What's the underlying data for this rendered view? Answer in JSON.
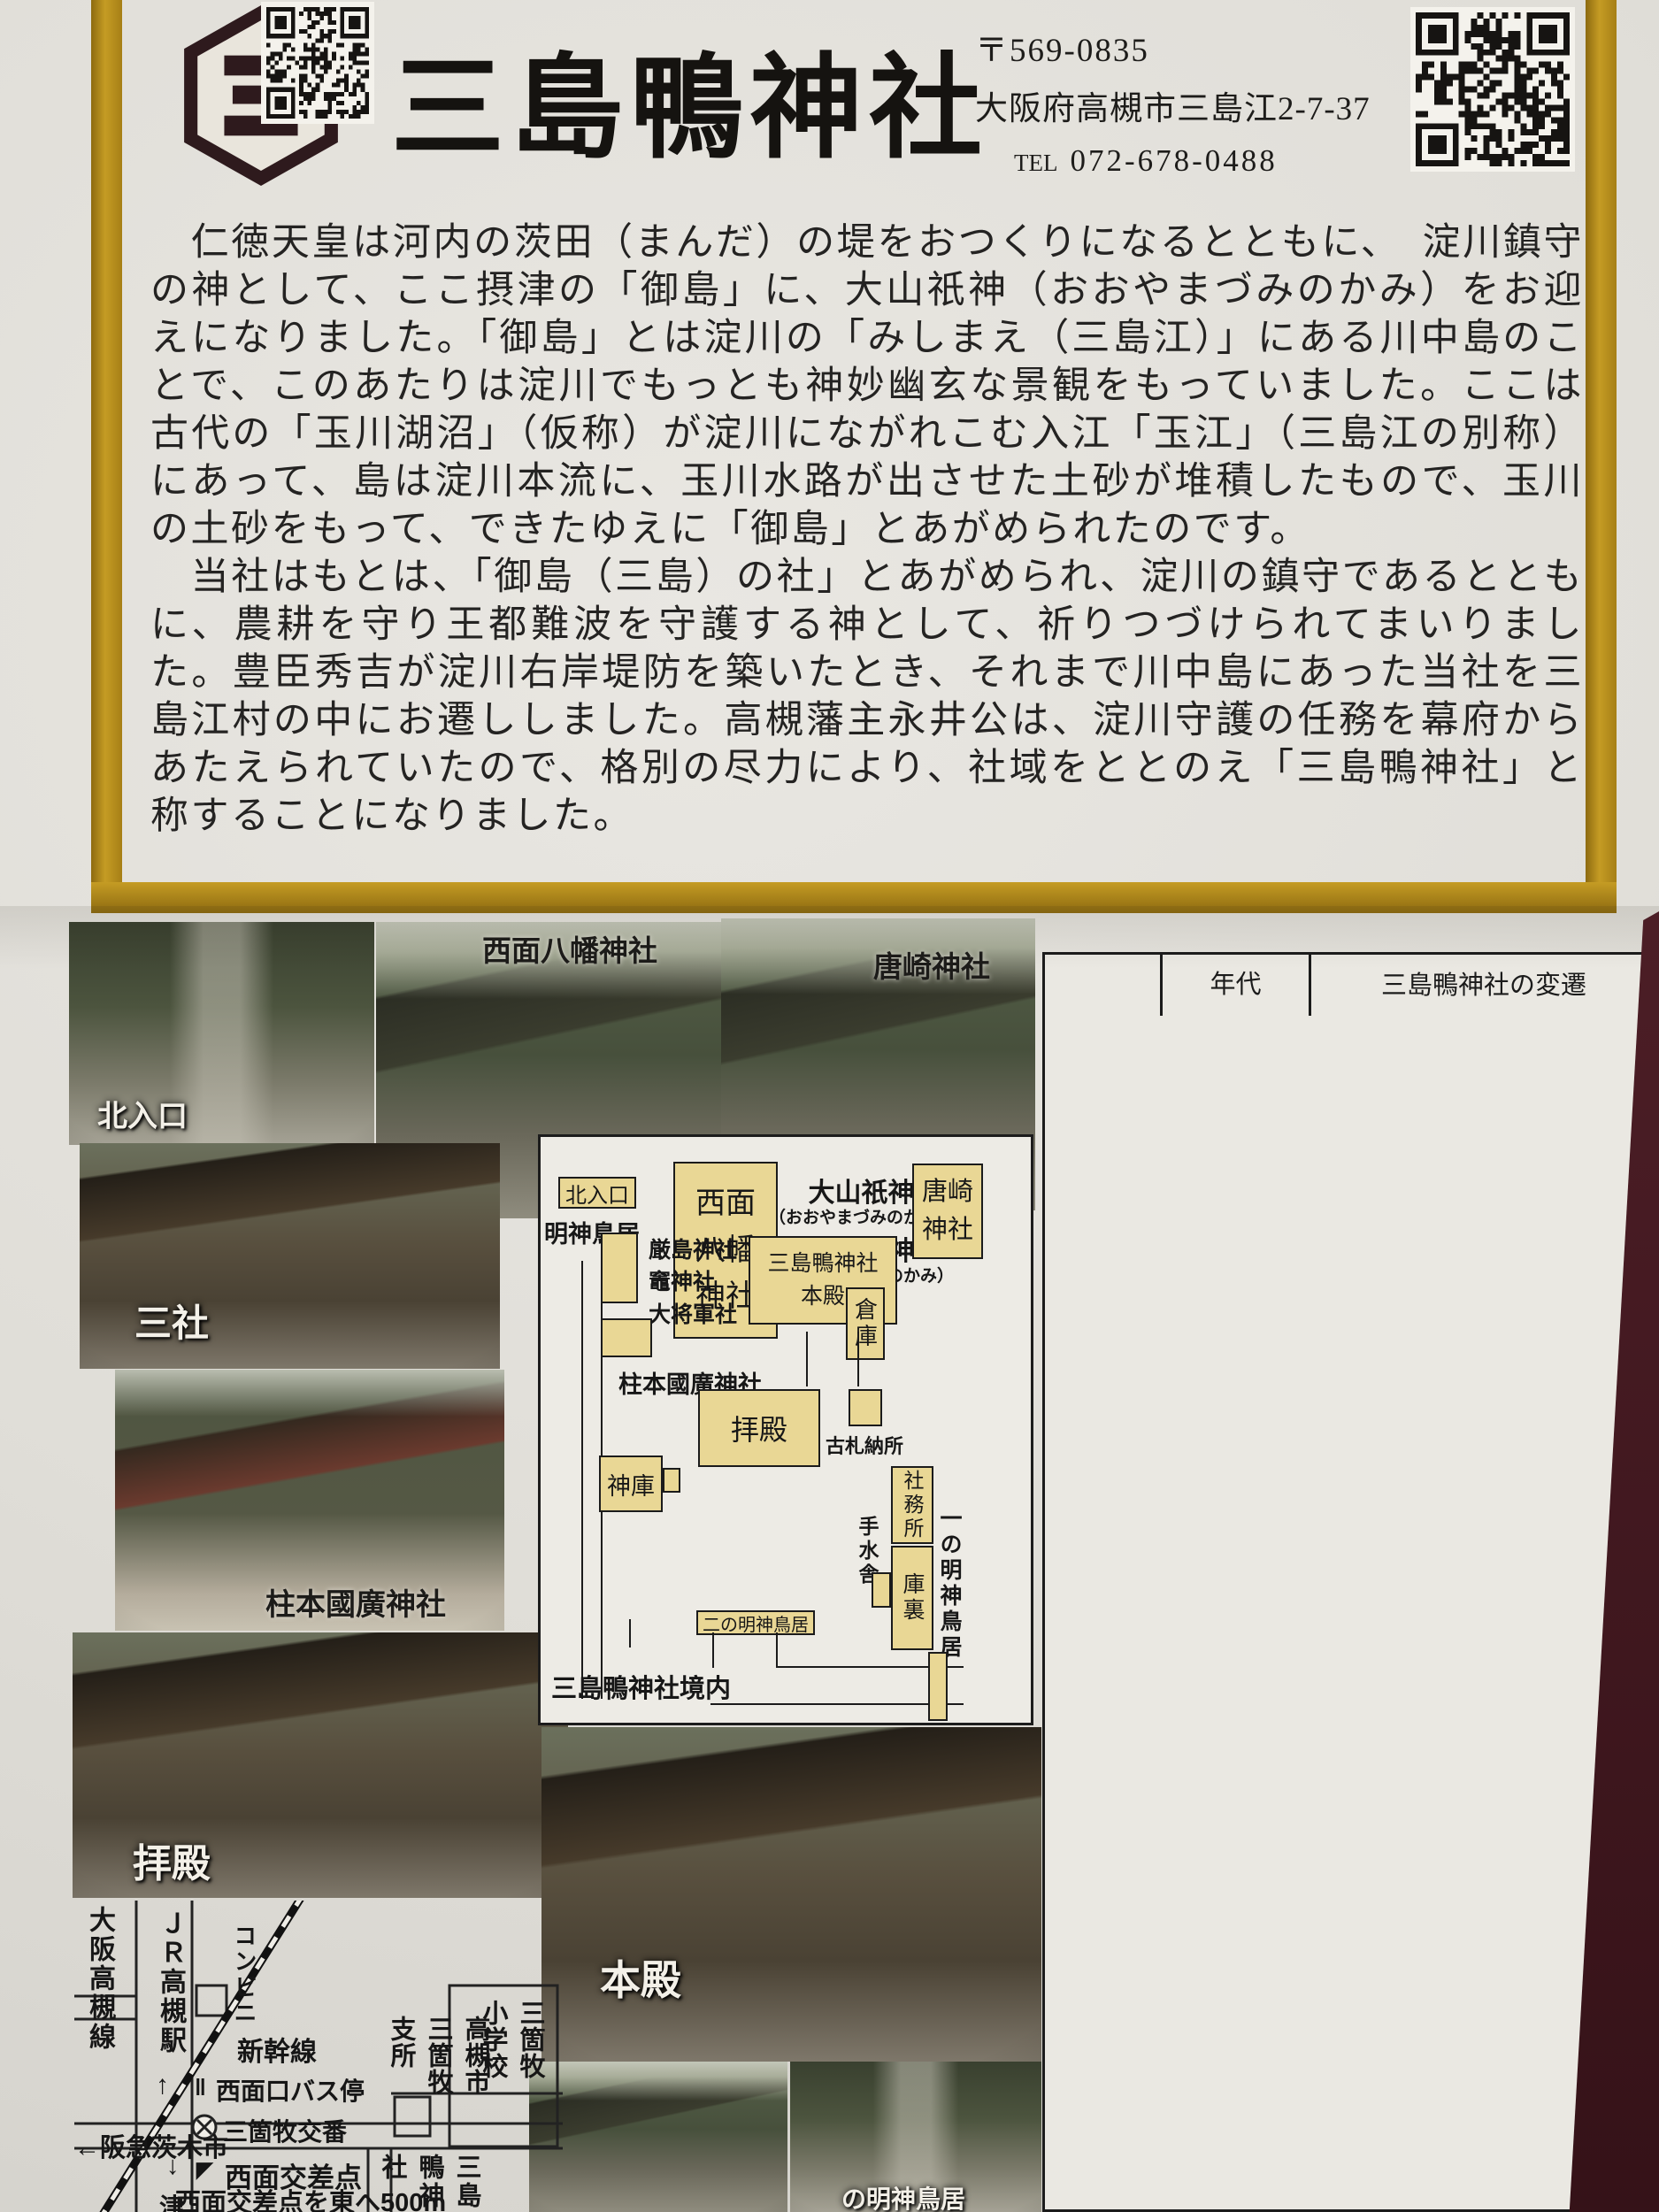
{
  "colors": {
    "gold": "#b9901f",
    "maroon": "#4a1d24",
    "box_tan": "#e9d795",
    "paper": "#e3e1db",
    "ink": "#1b1b1b"
  },
  "header": {
    "title": "三島鴨神社",
    "postal": "〒569-0835",
    "address": "大阪府高槻市三島江2-7-37",
    "tel_label": "TEL",
    "tel": "072-678-0488"
  },
  "intro": {
    "para1": "　仁徳天皇は河内の茨田（まんだ）の堤をおつくりになるとともに、　淀川鎮守の神として、ここ摂津の「御島」に、大山祇神（おおやまづみのかみ）をお迎えになりました。「御島」とは淀川の「みしまえ（三島江）」にある川中島のことで、このあたりは淀川でもっとも神妙幽玄な景観をもっていました。ここは古代の「玉川湖沼」（仮称）が淀川にながれこむ入江「玉江」（三島江の別称）にあって、島は淀川本流に、玉川水路が出させた土砂が堆積したもので、玉川の土砂をもって、できたゆえに「御島」とあがめられたのです。",
    "para2": "　当社はもとは、「御島（三島）の社」とあがめられ、淀川の鎮守であるとともに、農耕を守り王都難波を守護する神として、祈りつづけられてまいりました。豊臣秀吉が淀川右岸堤防を築いたとき、それまで川中島にあった当社を三島江村の中にお遷ししました。高槻藩主永井公は、淀川守護の任務を幕府からあたえられていたので、格別の尽力により、社域をととのえ「三島鴨神社」と称することになりました。"
  },
  "photos": {
    "north_entrance": "北入口",
    "saimen_hachiman": "西面八幡神社",
    "karasaki": "唐崎神社",
    "sansha": "三社",
    "hashiramoto": "柱本國廣神社",
    "haiden": "拝殿",
    "honden": "本殿",
    "torii_partial": "の明神鳥居"
  },
  "grounds_map": {
    "north_entrance": "北入口",
    "myojin_torii": "明神鳥居",
    "saimen_hachiman": "西面\n八幡\n神社",
    "deity1": "大山祇神",
    "deity1_kana": "（おおやまづみのかみ）",
    "deity2": "事代主神",
    "deity2_kana": "（ことしろぬしのかみ）",
    "karasaki": "唐崎\n神社",
    "massha": "厳島神社\n竈神社\n大将軍社",
    "honden": "三島鴨神社\n本殿",
    "soko": "倉庫",
    "hashiramoto": "柱本國廣神社",
    "haiden": "拝殿",
    "kosatsu": "古札納所",
    "shinko": "神庫",
    "shamusho": "社務所",
    "temizusha": "手水舎",
    "kuri": "庫裏",
    "ni_no_torii": "二の明神鳥居",
    "ichi_no_torii": "一の明神鳥居",
    "keidai": "三島鴨神社境内"
  },
  "table": {
    "headers": [
      "",
      "年代",
      "三島鴨神社の変遷"
    ],
    "rows": [
      {
        "era": "古墳時代\n初期",
        "year": "313～399",
        "desc": "第16代仁徳天皇在位\n　摂津御島に淀川鎮守の\n　　　　　やしろを作る"
      },
      {
        "era": "飛鳥時代\n奈良時代",
        "year": "660～720",
        "desc": "柿本人麻呂\n　　三島江を歌う（万葉集）\n神と天地に融合する\n　　　　歌枕の里となる"
      },
      {
        "era": "",
        "year": "時期不明",
        "desc": "摂津御島の三島社を分社\n　伊豫越知郡に「大山祇社」\n　伊豆賀茂郡に「三島神社」\n日本三三島として\n　　　　崇敬されはじめる"
      },
      {
        "era": "平安時代",
        "year": "905～927",
        "desc": "延長5年（927年）編纂の\n『延喜式神名帳』には\n式内社として\n「摂津国島下郡\n　　　　　三島鴨神社」\nの記載があり、\n　　　　その論社とされる"
      },
      {
        "era": "鎌倉時代",
        "year": "1205\n　（元久2）",
        "desc": "新古今和歌集に\n　玉江と玉川の歌が\n　　　　　　多く詠まれる"
      },
      {
        "era": "室町時代",
        "year": "1400年代",
        "desc": "唐崎に\n　三島神社の若宮出来る"
      },
      {
        "era": "安土桃山\n時代",
        "year": "1598\n　（慶長3）",
        "desc": "豊臣秀吉の命により\n　淀川右岸の堤防がつくられ\n　三島神社は川中島から\n　三島江村内に遷される"
      },
      {
        "era": "江戸時代",
        "year": "1697\n　（元禄10）",
        "desc": "高槻藩主の尽力で\n　延喜式内社　三島鴨神社\n　　　　　　　　　　と改称"
      },
      {
        "era": "明治時代",
        "year": "1908\n　（明治41）",
        "desc": "大字唐崎の「唐崎神社」\n大字柱本の\n　「天神社」「稲荷神社」\n大字西面の「八幡神社」"
      }
    ]
  },
  "street_map": {
    "osaka_takatsuki_line": "大阪高槻線",
    "jr_takatsuki": "ＪＲ高槻駅",
    "arrow_up": "↑",
    "conbini": "コンビニ",
    "shinkansen": "新幹線",
    "saimen_bus": "西面口バス停",
    "bus_mark": "‖",
    "koban": "三箇牧交番",
    "shisho": "高槻市三箇牧支所",
    "school": "三箇牧小学校",
    "hankyu": "←阪急茨木市",
    "arrow_down": "↓",
    "crossing_mark": "◤",
    "crossing": "西面交差点",
    "note1": "西面交差点を東へ500m",
    "note2": "高槻市三箇牧支所向",
    "mishima": "三島鴨神社",
    "tsu": "津"
  }
}
